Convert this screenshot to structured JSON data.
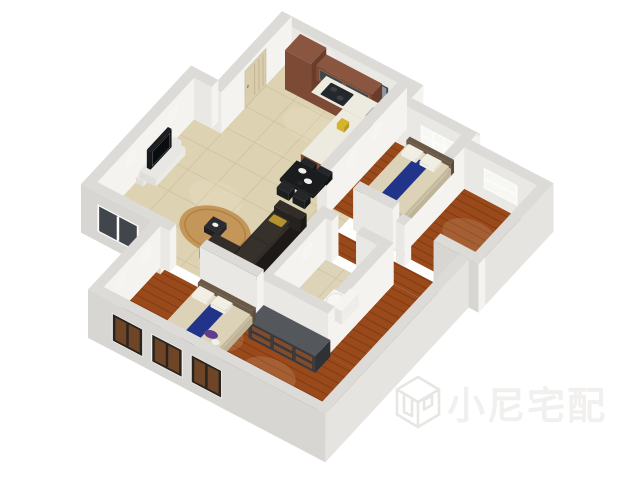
{
  "watermark": {
    "text": "小尼宅配",
    "logo": "cube-logo"
  },
  "colors": {
    "background": "#ffffff",
    "wall_top": "#dcdbd7",
    "wall_south": "#e9e8e4",
    "wall_east": "#f4f3f0",
    "wall_exterior": "#d7d6d2",
    "wall_exterior_east": "#e5e4e0",
    "tile_floor": "#ddd2b2",
    "tile_grout": "#cfc3a0",
    "bath_tile": "#ddd3b8",
    "wood_floor": "#99491a",
    "wood_line": "rgba(40,12,0,0.22)",
    "kitchen_wood": "#7c4a35",
    "kitchen_wood_dark": "#6a3d2b",
    "kitchen_wood_top": "#8a5640",
    "counter_top": "#edebdf",
    "hob": "#24272b",
    "sink": "#a7adb2",
    "oven": "#17191c",
    "bed_mattress": "#dcd2b8",
    "bed_side": "#cdc2a6",
    "bed_runner": "#223489",
    "bed_runner_dark": "#1b2b78",
    "pillow": "#f1eee4",
    "headboard": "#6b5948",
    "sofa": "#262220",
    "sofa_top": "#322d28",
    "sofa_cushion": "#36312b",
    "rug": "#c49659",
    "coffee_table": "#1f2022",
    "tv": "#101214",
    "tv_stand": "#e8e7e3",
    "dresser": "#3a3d42",
    "dresser_top": "#54575c",
    "dresser_wood": "#7e4c2e",
    "dining_table": "#151617",
    "chair": "#1d1e20",
    "toilet": "#f5f4f0",
    "window_glass_dark": "#9099a1",
    "window_glass_night": "#41464c",
    "window_glass_light": "#f7f7f3",
    "window_frame_white": "#fbfbfa",
    "window_frame_dark": "#2a241e",
    "window_wood": "#6e4526",
    "door": "#d9cdae",
    "deco_yellow": "#d4b429",
    "clothes_purple": "#5f3c8e",
    "clothes_white": "#eceae4",
    "watermark_fill": "#f1f0ee",
    "watermark_stroke": "#e7e6e2"
  }
}
